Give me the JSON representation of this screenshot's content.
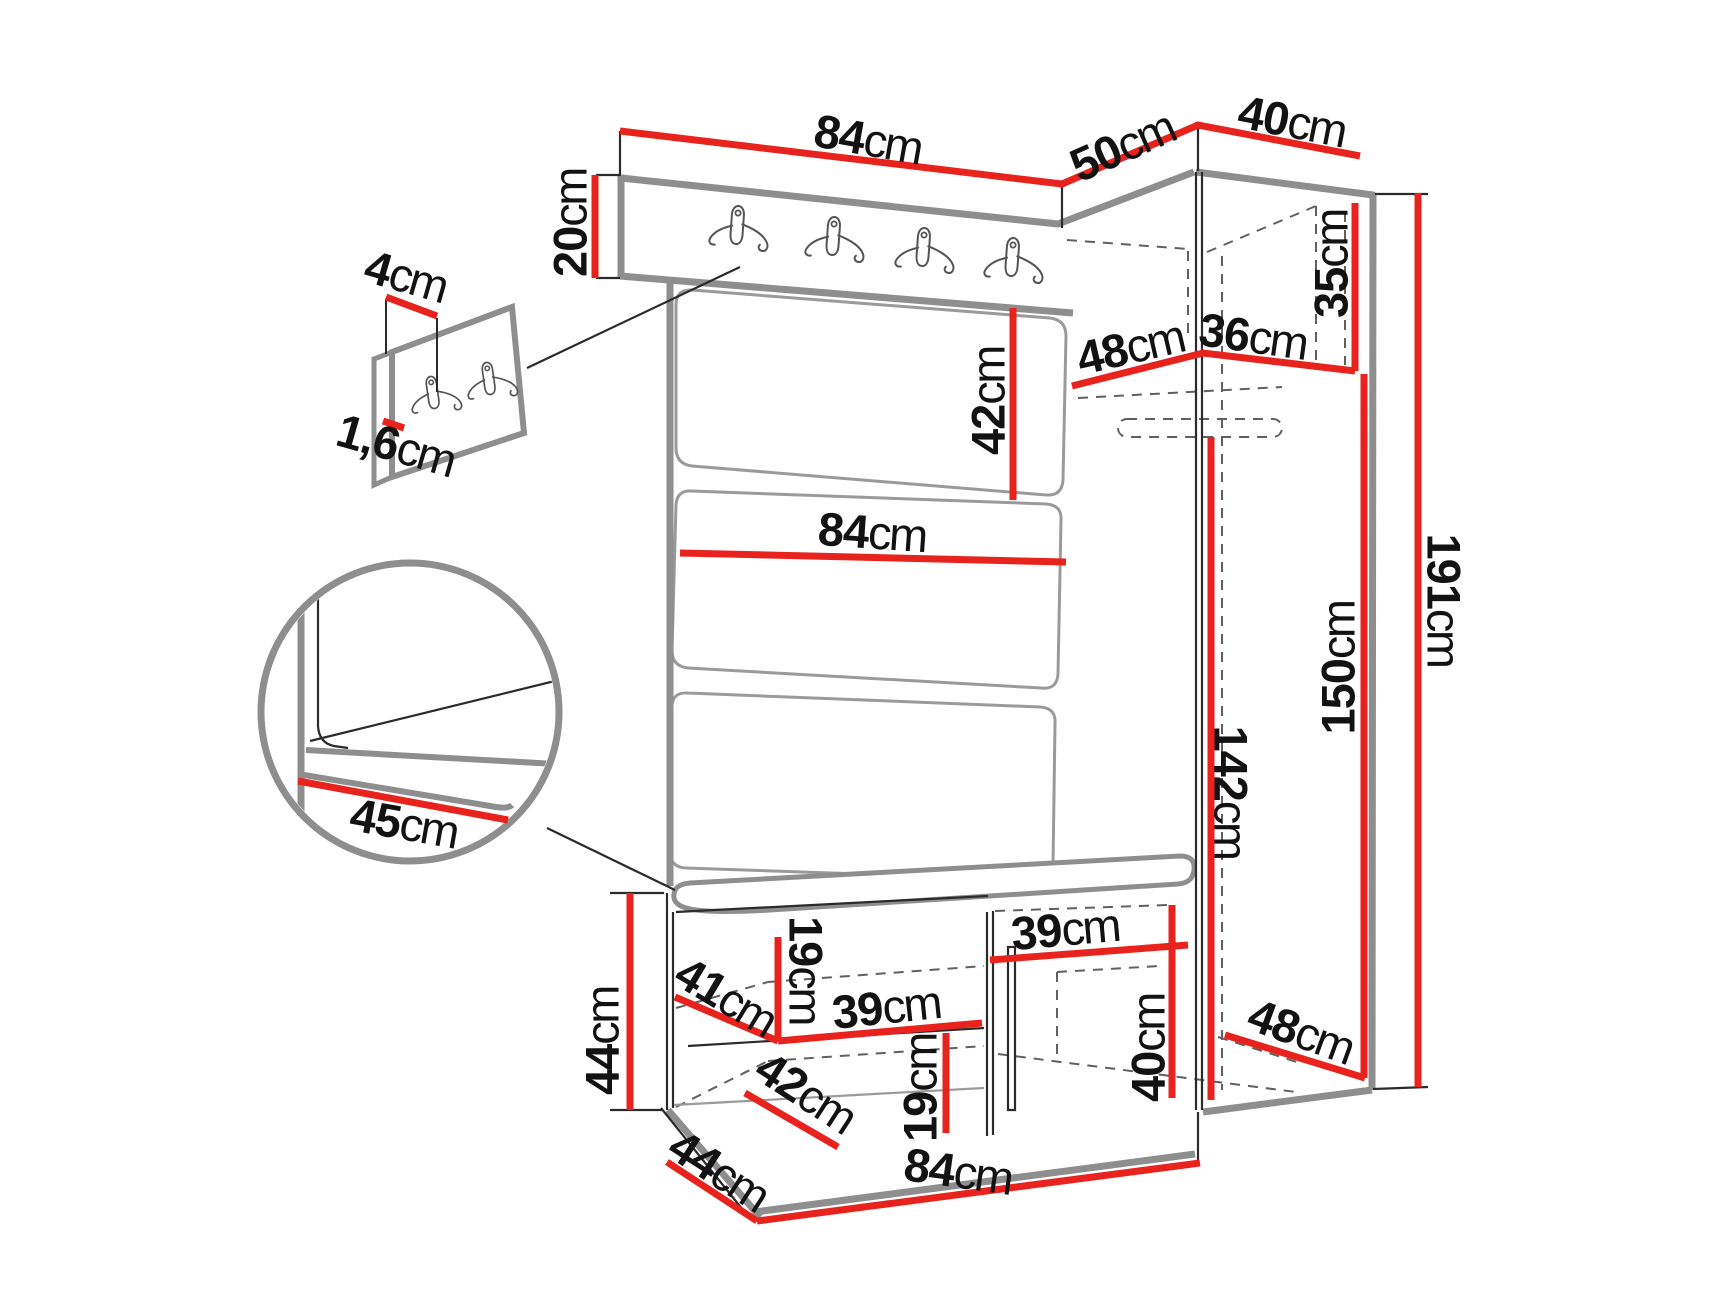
{
  "diagram": {
    "unit": "cm",
    "colors": {
      "dimension_line": "#e8231e",
      "furniture_edge_gray": "#8e8e8e",
      "thin_line": "#2b2b2b",
      "dashed_line": "#606060",
      "background": "#ffffff",
      "label_text": "#121212"
    },
    "icons": [
      "double-coat-hook-icon"
    ]
  },
  "dims": {
    "top_84": {
      "value": "84",
      "unit": "cm"
    },
    "top_50": {
      "value": "50",
      "unit": "cm"
    },
    "top_40": {
      "value": "40",
      "unit": "cm"
    },
    "side_20": {
      "value": "20",
      "unit": "cm"
    },
    "panel_4": {
      "value": "4",
      "unit": "cm"
    },
    "panel_1_6": {
      "value": "1,6",
      "unit": "cm"
    },
    "back_42": {
      "value": "42",
      "unit": "cm"
    },
    "mid_84": {
      "value": "84",
      "unit": "cm"
    },
    "shelf_48": {
      "value": "48",
      "unit": "cm"
    },
    "shelf_36": {
      "value": "36",
      "unit": "cm"
    },
    "shelf_35": {
      "value": "35",
      "unit": "cm"
    },
    "height_191": {
      "value": "191",
      "unit": "cm"
    },
    "height_150": {
      "value": "150",
      "unit": "cm"
    },
    "height_142": {
      "value": "142",
      "unit": "cm"
    },
    "seat_45": {
      "value": "45",
      "unit": "cm"
    },
    "bench_44": {
      "value": "44",
      "unit": "cm"
    },
    "depth_41": {
      "value": "41",
      "unit": "cm"
    },
    "shelf_39": {
      "value": "39",
      "unit": "cm"
    },
    "cubby_19_top": {
      "value": "19",
      "unit": "cm"
    },
    "depth_42": {
      "value": "42",
      "unit": "cm"
    },
    "cubby_19_bottom": {
      "value": "19",
      "unit": "cm"
    },
    "door_39": {
      "value": "39",
      "unit": "cm"
    },
    "box_40": {
      "value": "40",
      "unit": "cm"
    },
    "bottom_48": {
      "value": "48",
      "unit": "cm"
    },
    "bottom_84": {
      "value": "84",
      "unit": "cm"
    },
    "bottom_44": {
      "value": "44",
      "unit": "cm"
    }
  }
}
